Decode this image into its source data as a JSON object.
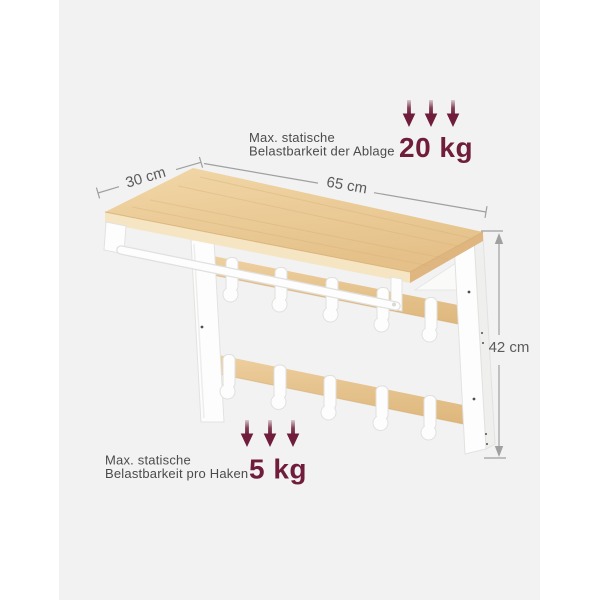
{
  "canvas": {
    "bg_outer": "#ffffff",
    "bg_inner": "#f2f2f2"
  },
  "colors": {
    "accent": "#6f1d3b",
    "wood_light": "#f1d7a7",
    "wood_dark": "#e5c189",
    "wood_edge_front": "#f5e5c3",
    "wood_edge_side": "#dfb67f",
    "metal_white": "#fdfdfd",
    "metal_outline": "#e2e2e0",
    "dim_line": "#a0a09e",
    "dim_text": "#5b5b5b",
    "label_text": "#4b4b4b"
  },
  "dimensions": {
    "depth": "30 cm",
    "width": "65 cm",
    "height": "42 cm"
  },
  "annotations": {
    "shelf_load": {
      "line1": "Max. statische",
      "line2": "Belastbarkeit der Ablage",
      "value": "20 kg"
    },
    "hook_load": {
      "line1": "Max. statische",
      "line2": "Belastbarkeit pro Haken",
      "value": "5 kg"
    }
  },
  "product": {
    "hook_rows": 2,
    "hooks_per_row": 5
  }
}
